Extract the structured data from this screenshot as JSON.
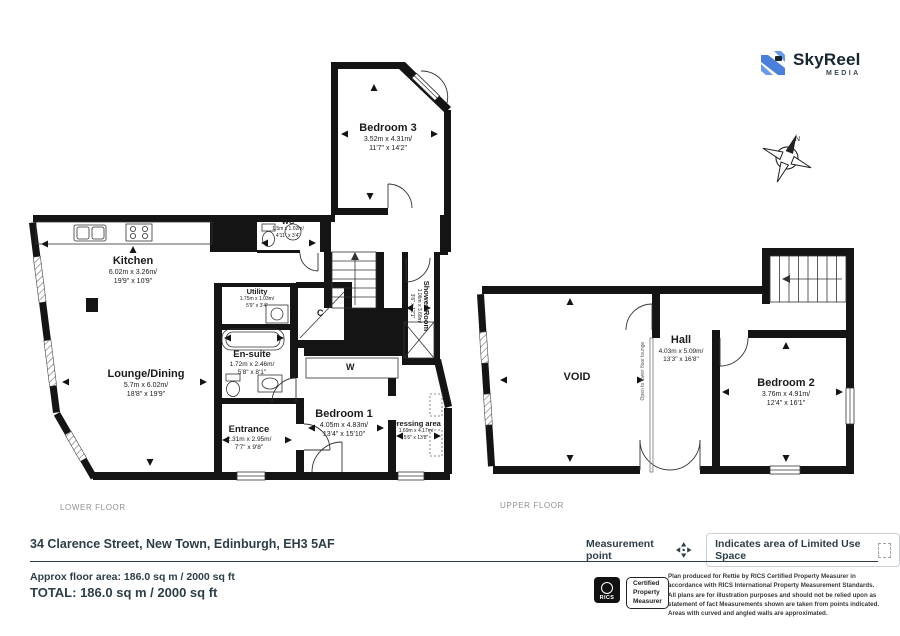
{
  "logo": {
    "name": "SkyReel",
    "sub": "MEDIA"
  },
  "compass": {
    "north_label": "N"
  },
  "colors": {
    "wall": "#141414",
    "brand_blue": "#4a80d9",
    "footer_text": "#2d3e48"
  },
  "floors": {
    "lower": {
      "label": "LOWER FLOOR",
      "rooms": [
        {
          "id": "bedroom3",
          "name": "Bedroom 3",
          "metric": "3.52m x 4.31m/",
          "imperial": "11'7\" x 14'2\""
        },
        {
          "id": "kitchen",
          "name": "Kitchen",
          "metric": "6.02m x 3.26m/",
          "imperial": "19'9\" x 10'9\""
        },
        {
          "id": "wc",
          "name": "WC",
          "metric": "1.5m x 1.02m/",
          "imperial": "4'11\" x 3'4\""
        },
        {
          "id": "utility",
          "name": "Utility",
          "metric": "1.75m x 1.03m/",
          "imperial": "5'9\" x 3'4\""
        },
        {
          "id": "lounge",
          "name": "Lounge/Dining",
          "metric": "5.7m x 6.02m/",
          "imperial": "18'8\" x 19'9\""
        },
        {
          "id": "ensuite",
          "name": "En-suite",
          "metric": "1.72m x 2.46m/",
          "imperial": "5'8\" x 8'1\""
        },
        {
          "id": "shower",
          "name": "Shower Room",
          "metric": "1.06m x 3.68m/",
          "imperial": "3'6\" x 12'1\""
        },
        {
          "id": "entrance",
          "name": "Entrance",
          "metric": "2.31m x 2.95m/",
          "imperial": "7'7\" x 9'8\""
        },
        {
          "id": "bedroom1",
          "name": "Bedroom 1",
          "metric": "4.05m x 4.83m/",
          "imperial": "13'4\" x 15'10\""
        },
        {
          "id": "dressing",
          "name": "Dressing area",
          "metric": "1.69m x 4.17m/",
          "imperial": "5'6\" x 13'8\""
        },
        {
          "id": "closet",
          "name": "C"
        },
        {
          "id": "wardrobe",
          "name": "W"
        }
      ]
    },
    "upper": {
      "label": "UPPER FLOOR",
      "annotation": "Open to lower floor lounge",
      "rooms": [
        {
          "id": "void",
          "name": "VOID"
        },
        {
          "id": "hall",
          "name": "Hall",
          "metric": "4.03m x 5.09m/",
          "imperial": "13'3\" x 16'8\""
        },
        {
          "id": "bedroom2",
          "name": "Bedroom 2",
          "metric": "3.76m x 4.91m/",
          "imperial": "12'4\" x 16'1\""
        }
      ]
    }
  },
  "footer": {
    "address": "34 Clarence Street, New Town, Edinburgh, EH3 5AF",
    "legend": {
      "measurement_point": "Measurement point",
      "limited_use": "Indicates area of  Limited Use Space"
    },
    "approx_area": "Approx floor area: 186.0 sq m / 2000 sq ft",
    "total": "TOTAL:  186.0 sq m / 2000 sq ft",
    "rics": {
      "logo_text": "RICS",
      "badge_lines": [
        "Certified",
        "Property",
        "Measurer"
      ],
      "disclaimer": "Plan produced for Rettie by RICS Certified Property Measurer in accordance with RICS International Property Measurement Standards.  All plans are for illustration purposes and should not be relied upon as statement of fact Measurements shown are taken from points indicated. Areas with curved and angled walls are approximated."
    }
  }
}
